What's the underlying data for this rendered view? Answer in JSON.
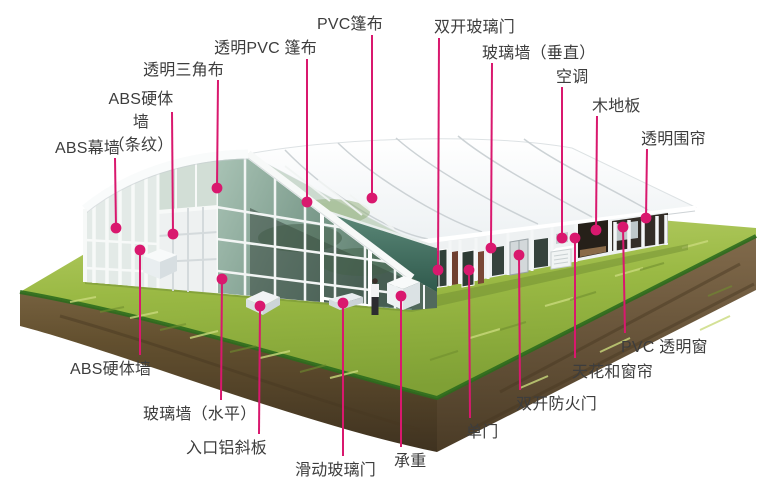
{
  "page": {
    "width": 757,
    "height": 500,
    "background": "#ffffff"
  },
  "scene": {
    "description": "3D cutaway illustration of a large event tent with glass walls standing on a floating grass-and-soil island diorama",
    "palette": {
      "callout_accent": "#d9186e",
      "label_text": "#3d3d3d",
      "grass_light": "#b9d06a",
      "grass": "#9ab944",
      "grass_rim": "#2c6b1d",
      "soil_light": "#7d684a",
      "soil": "#6a5434",
      "soil_dark": "#3f3220",
      "roof_white": "#fcfdfe",
      "roof_seam": "#ccd2d5",
      "glass_teal": "#7d9c8d",
      "glass_dark": "#31413a",
      "awning_teal": "#3f6d5f",
      "frame_white": "#f4f6f7"
    }
  },
  "callouts": [
    {
      "id": "abs-curtain-wall",
      "text": "ABS幕墙",
      "side": "top",
      "label": {
        "x": 55,
        "y": 137
      },
      "line": {
        "x": 115,
        "y1": 158
      },
      "dot": {
        "x": 116,
        "y": 228
      }
    },
    {
      "id": "abs-hard-wall-striped",
      "text": "ABS硬体墙\n（条纹）",
      "side": "top",
      "label": {
        "x": 101,
        "y": 88,
        "w": 80,
        "align": "center"
      },
      "line": {
        "x": 172,
        "y1": 112
      },
      "dot": {
        "x": 173,
        "y": 234
      }
    },
    {
      "id": "clear-gable-cloth",
      "text": "透明三角布",
      "side": "top",
      "label": {
        "x": 143,
        "y": 59
      },
      "line": {
        "x": 218,
        "y1": 80
      },
      "dot": {
        "x": 217,
        "y": 188
      }
    },
    {
      "id": "clear-pvc-canopy",
      "text": "透明PVC 篷布",
      "side": "top",
      "label": {
        "x": 214,
        "y": 37
      },
      "line": {
        "x": 307,
        "y1": 59
      },
      "dot": {
        "x": 307,
        "y": 202
      }
    },
    {
      "id": "pvc-canopy",
      "text": "PVC篷布",
      "side": "top",
      "label": {
        "x": 317,
        "y": 13
      },
      "line": {
        "x": 372,
        "y1": 35
      },
      "dot": {
        "x": 372,
        "y": 198
      }
    },
    {
      "id": "double-glass-door",
      "text": "双开玻璃门",
      "side": "top",
      "label": {
        "x": 434,
        "y": 16
      },
      "line": {
        "x": 439,
        "y1": 38
      },
      "dot": {
        "x": 438,
        "y": 270
      }
    },
    {
      "id": "glass-wall-vertical",
      "text": "玻璃墙（垂直）",
      "side": "top",
      "label": {
        "x": 482,
        "y": 42
      },
      "line": {
        "x": 492,
        "y1": 63
      },
      "dot": {
        "x": 491,
        "y": 248
      }
    },
    {
      "id": "air-conditioner",
      "text": "空调",
      "side": "top",
      "label": {
        "x": 556,
        "y": 66
      },
      "line": {
        "x": 562,
        "y1": 87
      },
      "dot": {
        "x": 562,
        "y": 238
      }
    },
    {
      "id": "wood-floor",
      "text": "木地板",
      "side": "top",
      "label": {
        "x": 592,
        "y": 95
      },
      "line": {
        "x": 597,
        "y1": 116
      },
      "dot": {
        "x": 596,
        "y": 230
      }
    },
    {
      "id": "clear-side-curtain",
      "text": "透明围帘",
      "side": "top",
      "label": {
        "x": 641,
        "y": 128
      },
      "line": {
        "x": 647,
        "y1": 149
      },
      "dot": {
        "x": 646,
        "y": 218
      }
    },
    {
      "id": "abs-hard-wall",
      "text": "ABS硬体墙",
      "side": "bottom",
      "label": {
        "x": 70,
        "y": 358
      },
      "line": {
        "x": 140,
        "y1": 355
      },
      "dot": {
        "x": 140,
        "y": 250
      }
    },
    {
      "id": "glass-wall-horizontal",
      "text": "玻璃墙（水平）",
      "side": "bottom",
      "label": {
        "x": 143,
        "y": 403
      },
      "line": {
        "x": 221,
        "y1": 400
      },
      "dot": {
        "x": 222,
        "y": 279
      }
    },
    {
      "id": "entrance-ramp",
      "text": "入口铝斜板",
      "side": "bottom",
      "label": {
        "x": 186,
        "y": 437
      },
      "line": {
        "x": 259,
        "y1": 434
      },
      "dot": {
        "x": 260,
        "y": 306
      }
    },
    {
      "id": "sliding-glass-door",
      "text": "滑动玻璃门",
      "side": "bottom",
      "label": {
        "x": 295,
        "y": 459
      },
      "line": {
        "x": 343,
        "y1": 456
      },
      "dot": {
        "x": 343,
        "y": 303
      }
    },
    {
      "id": "load-bearing",
      "text": "承重",
      "side": "bottom",
      "label": {
        "x": 394,
        "y": 450
      },
      "line": {
        "x": 401,
        "y1": 447
      },
      "dot": {
        "x": 401,
        "y": 296
      }
    },
    {
      "id": "single-door",
      "text": "单门",
      "side": "bottom",
      "label": {
        "x": 466,
        "y": 421
      },
      "line": {
        "x": 470,
        "y1": 418
      },
      "dot": {
        "x": 469,
        "y": 270
      }
    },
    {
      "id": "double-fire-door",
      "text": "双开防火门",
      "side": "bottom",
      "label": {
        "x": 516,
        "y": 393
      },
      "line": {
        "x": 520,
        "y1": 390
      },
      "dot": {
        "x": 519,
        "y": 255
      }
    },
    {
      "id": "ceiling-and-curtain",
      "text": "天花和窗帘",
      "side": "bottom",
      "label": {
        "x": 572,
        "y": 361
      },
      "line": {
        "x": 575,
        "y1": 358
      },
      "dot": {
        "x": 575,
        "y": 238
      }
    },
    {
      "id": "pvc-clear-window",
      "text": "PVC 透明窗",
      "side": "bottom",
      "label": {
        "x": 621,
        "y": 336
      },
      "line": {
        "x": 625,
        "y1": 333
      },
      "dot": {
        "x": 623,
        "y": 227
      }
    }
  ]
}
